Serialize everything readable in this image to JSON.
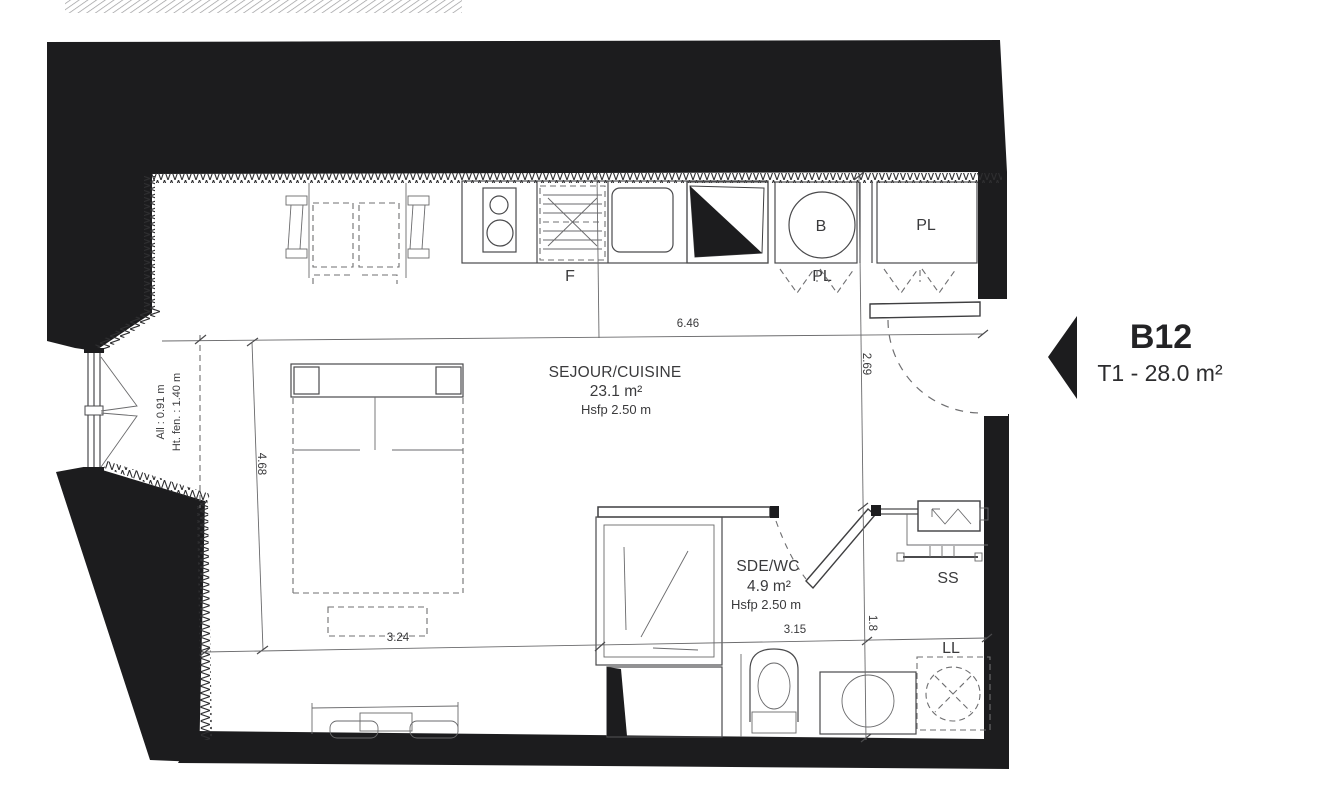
{
  "unit": {
    "code": "B12",
    "type_area": "T1 - 28.0 m²"
  },
  "rooms": {
    "living": {
      "name": "SEJOUR/CUISINE",
      "area": "23.1 m²",
      "ceiling": "Hsfp 2.50 m"
    },
    "bathroom": {
      "name": "SDE/WC",
      "area": "4.9 m²",
      "ceiling": "Hsfp 2.50 m"
    }
  },
  "equipment": {
    "fridge": "F",
    "water_heater": "B",
    "closet_entry": "PL",
    "closet_wall": "PL",
    "towel_dryer": "SS",
    "washer": "LL"
  },
  "dimensions": {
    "living_width": "6.46",
    "living_depth": "4.68",
    "living_bottom": "3.24",
    "bathroom_width": "3.15",
    "entry_depth": "2.69",
    "bathroom_depth": "1.8"
  },
  "window": {
    "sill": "All : 0.91 m",
    "height": "Ht. fen. : 1.40 m"
  },
  "colors": {
    "wall": "#1c1c1e",
    "line": "#4a4a4c",
    "text": "#3a3a3c"
  }
}
